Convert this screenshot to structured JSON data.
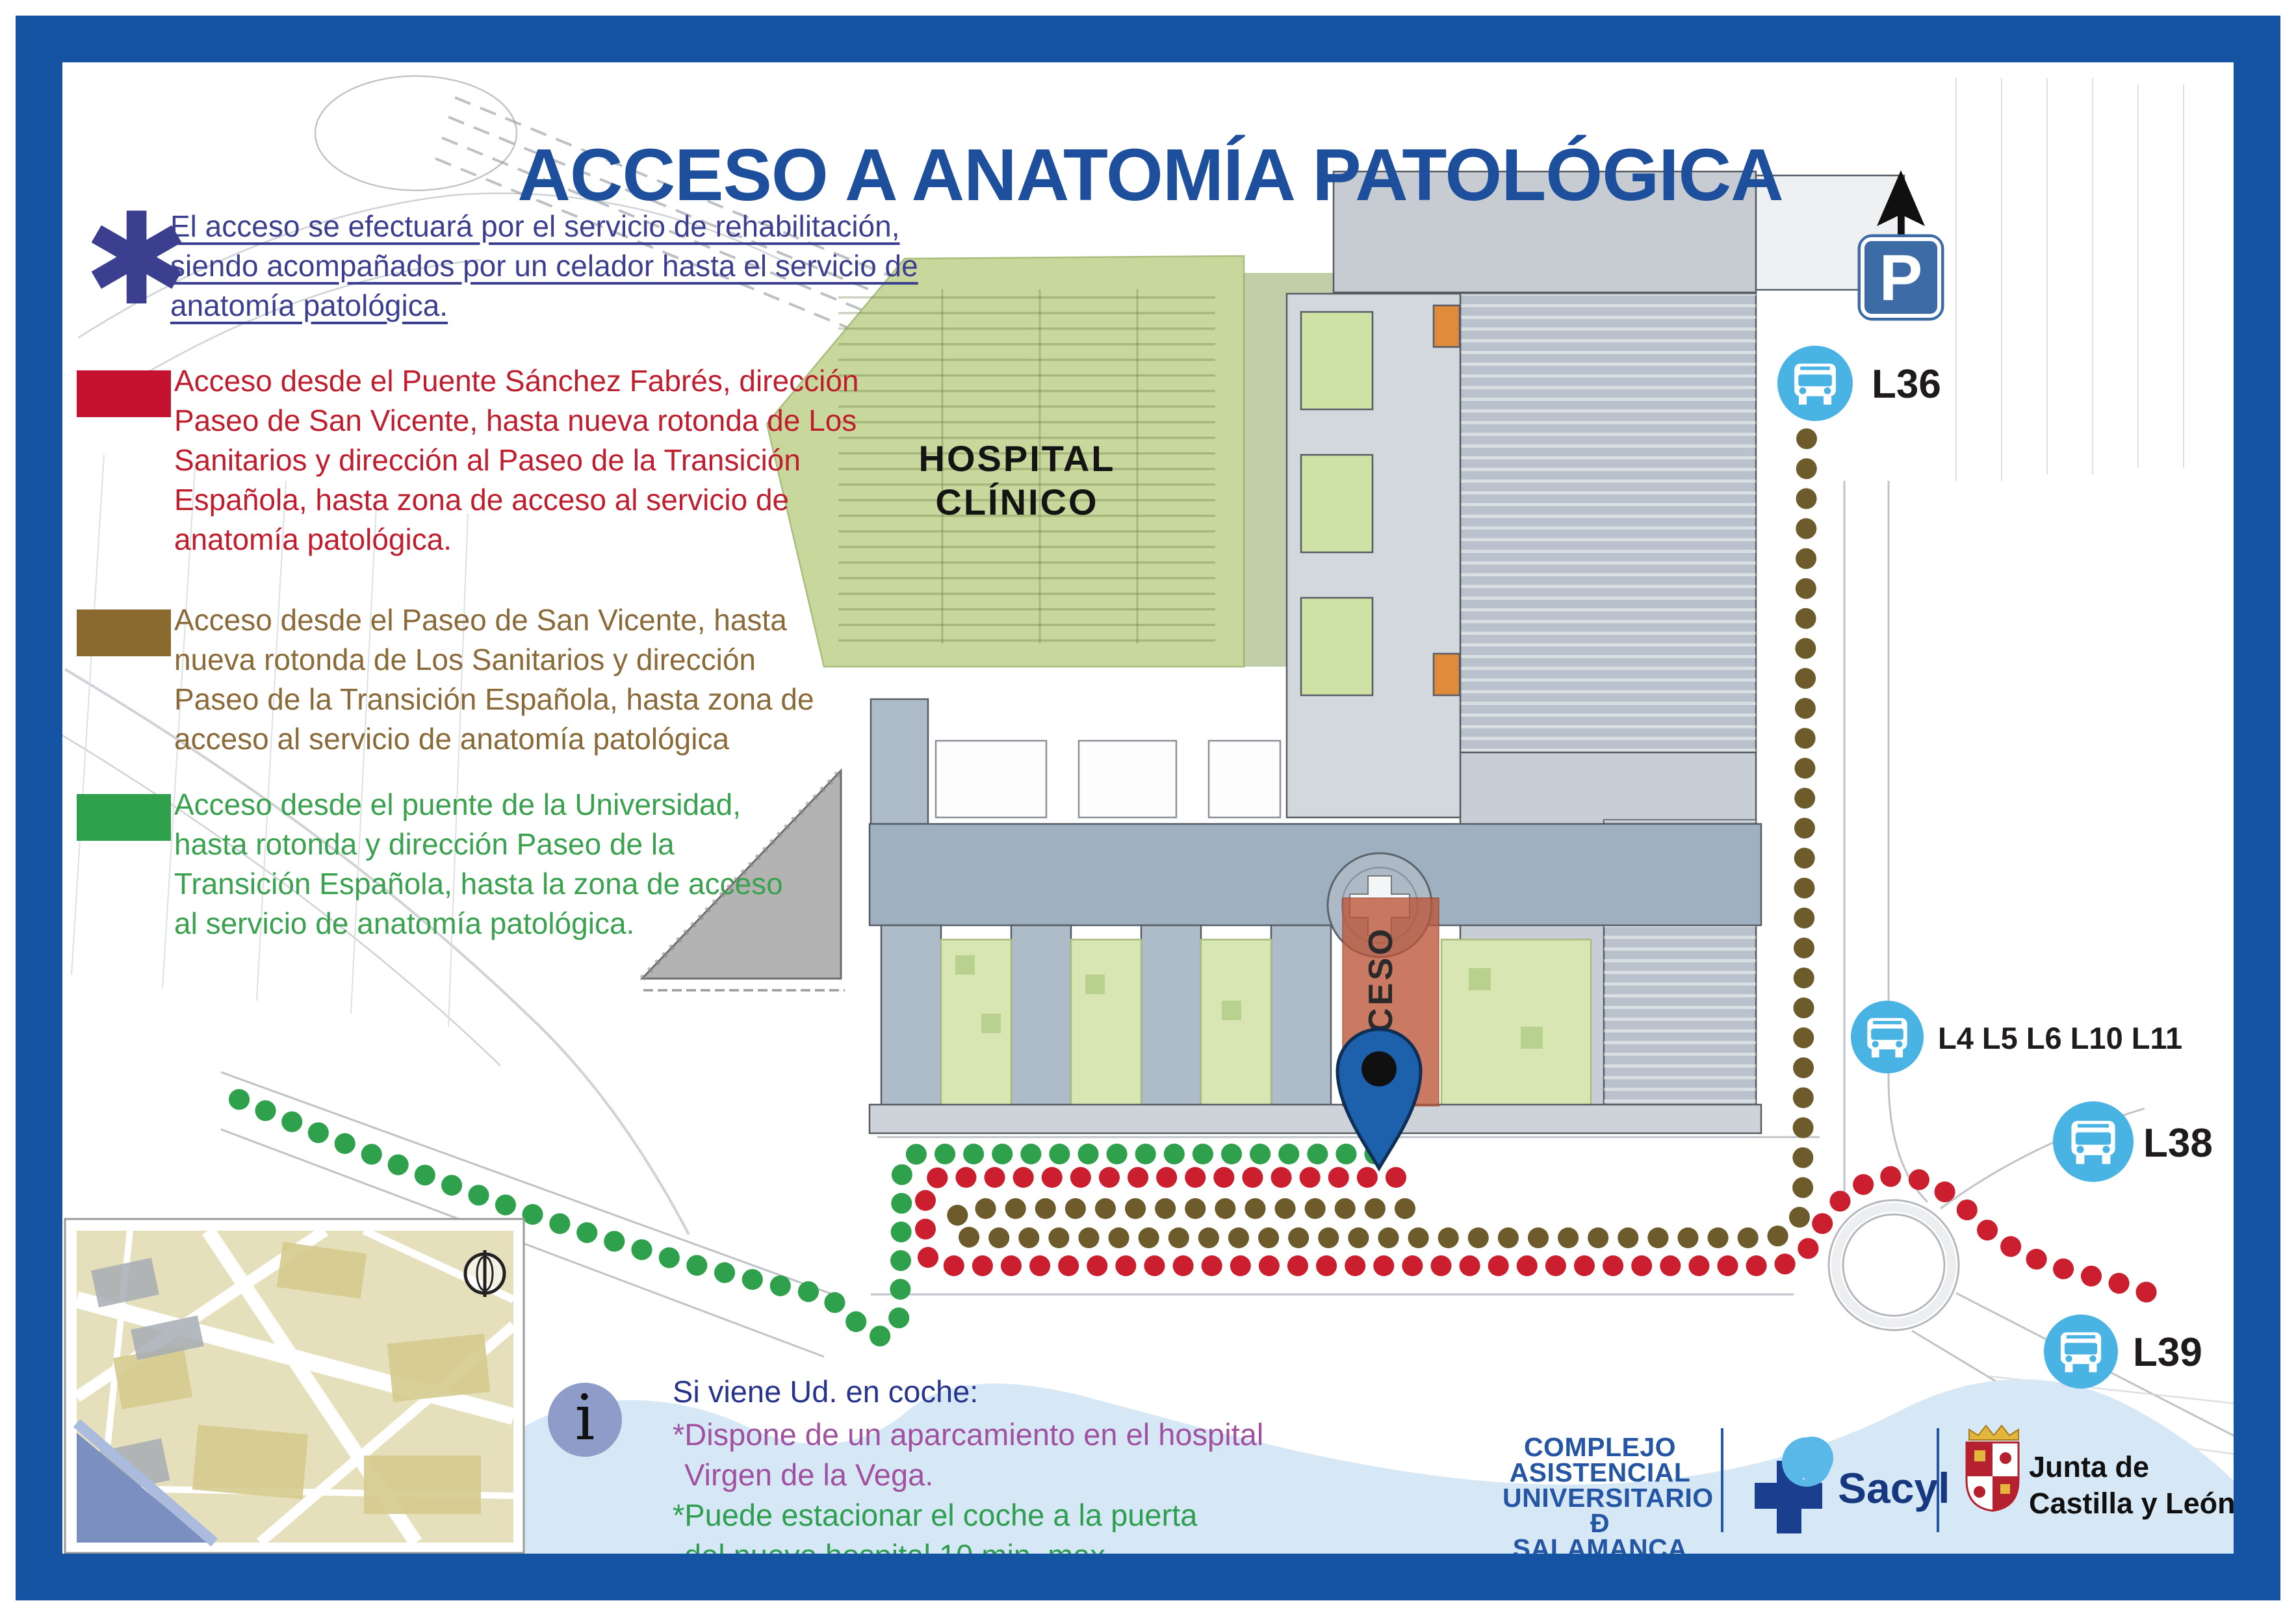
{
  "title": "ACCESO A ANATOMÍA PATOLÓGICA",
  "note": {
    "symbol": "✱",
    "text": "El acceso se efectuará por el servicio de rehabilitación, siendo acompañados por un celador hasta el servicio de anatomía patológica.",
    "color": "#3c3f8f"
  },
  "legend": {
    "items": [
      {
        "id": "red-route",
        "swatch": "#c41230",
        "color": "#be1e2d",
        "text": "Acceso desde el Puente Sánchez Fabrés, dirección Paseo de San Vicente, hasta nueva rotonda de Los Sanitarios y dirección al Paseo de la Transición Española, hasta zona de acceso al servicio de anatomía patológica."
      },
      {
        "id": "brown-route",
        "swatch": "#8a6a2f",
        "color": "#8a6a38",
        "text": "Acceso desde el Paseo de San Vicente, hasta nueva rotonda de Los Sanitarios y dirección Paseo de la Transición Española, hasta zona de acceso al servicio de anatomía patológica"
      },
      {
        "id": "green-route",
        "swatch": "#2fa04b",
        "color": "#3aa14f",
        "text": "Acceso desde el puente de la Universidad, hasta rotonda y dirección Paseo de la Transición Española, hasta la zona de acceso al servicio de anatomía patológica."
      }
    ]
  },
  "map": {
    "hospital_label_line1": "HOSPITAL",
    "hospital_label_line2": "CLÍNICO",
    "acceso_label": "ACCESO",
    "parking_sign": "P",
    "bus_color": "#49b3e4",
    "bus_stops": [
      {
        "label": "L36"
      },
      {
        "label": "L4 L5 L6 L10 L11"
      },
      {
        "label": "L38"
      },
      {
        "label": "L39"
      }
    ]
  },
  "route_colors": {
    "red": "#cb1f2f",
    "brown": "#6d5b2b",
    "green": "#2fa14d"
  },
  "info": {
    "icon_glyph": "i",
    "heading": "Si viene Ud. en coche:",
    "heading_color": "#27348b",
    "lines": [
      {
        "text": "*Dispone de un aparcamiento en el hospital",
        "color": "#a0519f"
      },
      {
        "text": "Virgen de la Vega.",
        "color": "#a0519f"
      },
      {
        "text": "*Puede estacionar el coche a la puerta",
        "color": "#2f9e51"
      },
      {
        "text": "del nuevo hospital 10 min. max.",
        "color": "#2f9e51"
      }
    ]
  },
  "footer": {
    "complejo": [
      "COMPLEJO",
      "ASISTENCIAL",
      "UNIVERSITARIO",
      "Ð SALAMANCA"
    ],
    "sacyl": "Sacyl",
    "junta_line1": "Junta de",
    "junta_line2": "Castilla y León"
  }
}
